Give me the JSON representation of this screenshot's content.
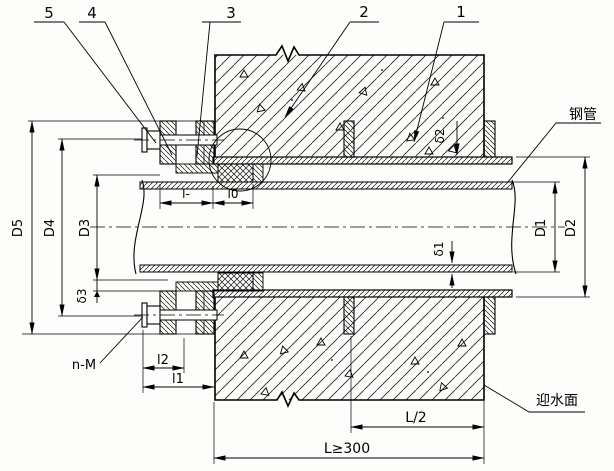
{
  "callouts": [
    {
      "label": "1"
    },
    {
      "label": "2"
    },
    {
      "label": "3"
    },
    {
      "label": "4"
    },
    {
      "label": "5"
    }
  ],
  "part_labels": {
    "steel_pipe": "钢管",
    "water_facing_side": "迎水面"
  },
  "dimensions": {
    "D1": "D1",
    "D2": "D2",
    "D3": "D3",
    "D4": "D4",
    "D5": "D5",
    "delta1": "δ1",
    "delta2": "δ2",
    "delta3": "δ3",
    "l": "l-",
    "l0": "l0",
    "l1": "l1",
    "l2": "l2",
    "bolts": "n-M",
    "half_length": "L/2",
    "min_length": "L≥300"
  },
  "line_color": "#000000",
  "background": "#fdfdfc"
}
